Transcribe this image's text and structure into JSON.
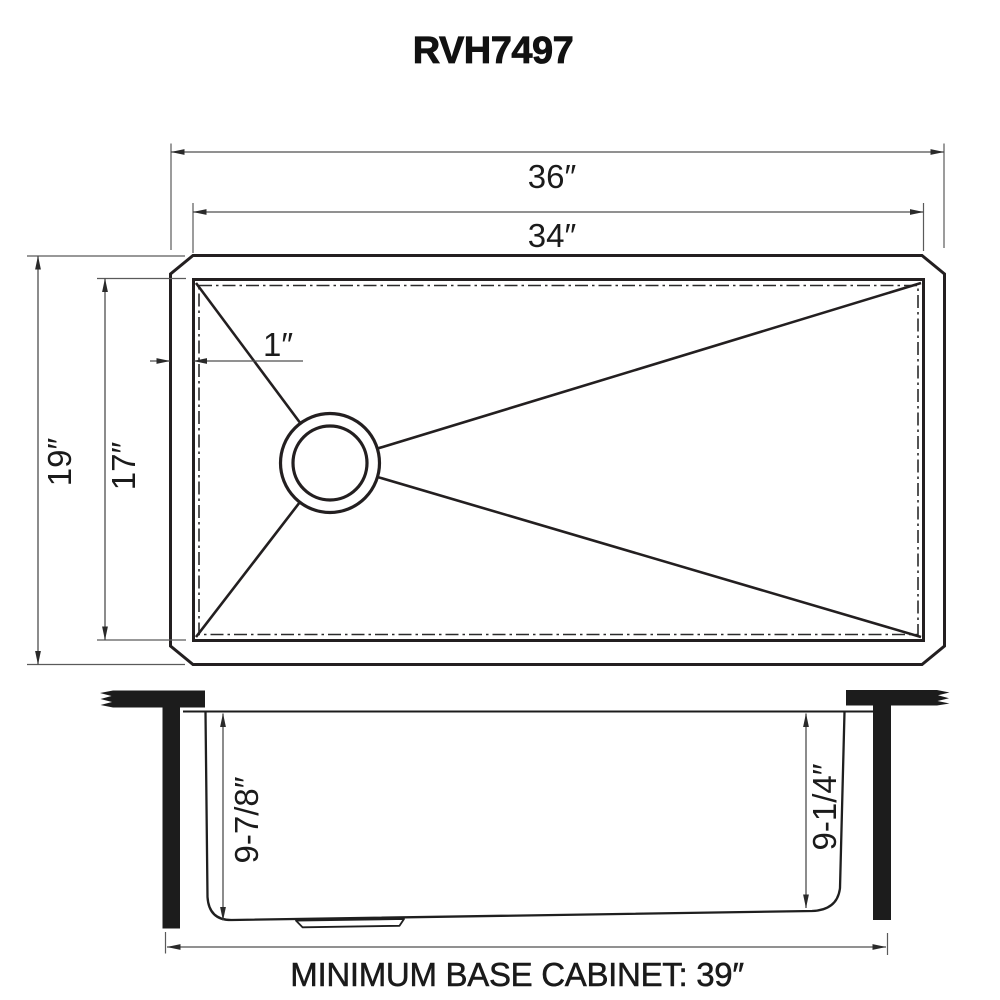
{
  "title": "RVH7497",
  "plan_view": {
    "overall_width": "36″",
    "bowl_width": "34″",
    "overall_front_to_back": "19″",
    "bowl_front_to_back": "17″",
    "rim_width": "1″"
  },
  "section_view": {
    "bowl_depth_left": "9-7/8″",
    "bowl_depth_right": "9-1/4″",
    "base_cabinet_note": "MINIMUM BASE CABINET: 39″"
  },
  "colors": {
    "line_color": "#231f20",
    "dimension_color": "#4f4f4f",
    "background": "#ffffff"
  }
}
